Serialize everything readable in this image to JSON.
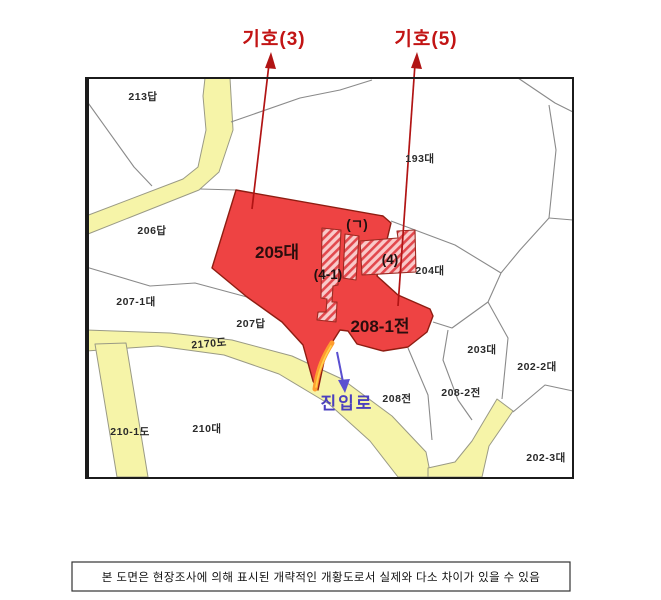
{
  "legend_markers": {
    "marker3": "기호(3)",
    "marker5": "기호(5)"
  },
  "zones": {
    "main_parcel": "205대",
    "field_parcel": "208-1전",
    "sub_g": "(ㄱ)",
    "sub_4_1": "(4-1)",
    "sub_4": "(4)"
  },
  "access_road": {
    "label": "진입로"
  },
  "parcels": [
    {
      "label": "213답"
    },
    {
      "label": "206답"
    },
    {
      "label": "207-1대"
    },
    {
      "label": "207답"
    },
    {
      "label": "2170도"
    },
    {
      "label": "210-1도"
    },
    {
      "label": "210대"
    },
    {
      "label": "208전"
    },
    {
      "label": "193대"
    },
    {
      "label": "204대"
    },
    {
      "label": "203대"
    },
    {
      "label": "208-2전"
    },
    {
      "label": "202-2대"
    },
    {
      "label": "202-3대"
    }
  ],
  "note": "본 도면은 현장조사에 의해 표시된 개략적인 개황도로서 실제와 다소 차이가 있을 수 있음",
  "colors": {
    "highlight_red": "#ee4343",
    "highlight_red_border": "#8e1d12",
    "hatch_background": "#f9caca",
    "hatch_stripe": "#e2484d",
    "road_yellow": "#f6f4a8",
    "parcel_line_gray": "#8a8a8a",
    "marker_text_red": "#c21414",
    "access_text_blue": "#4a3fbf",
    "access_highlight_orange": "#ff9d2e"
  }
}
